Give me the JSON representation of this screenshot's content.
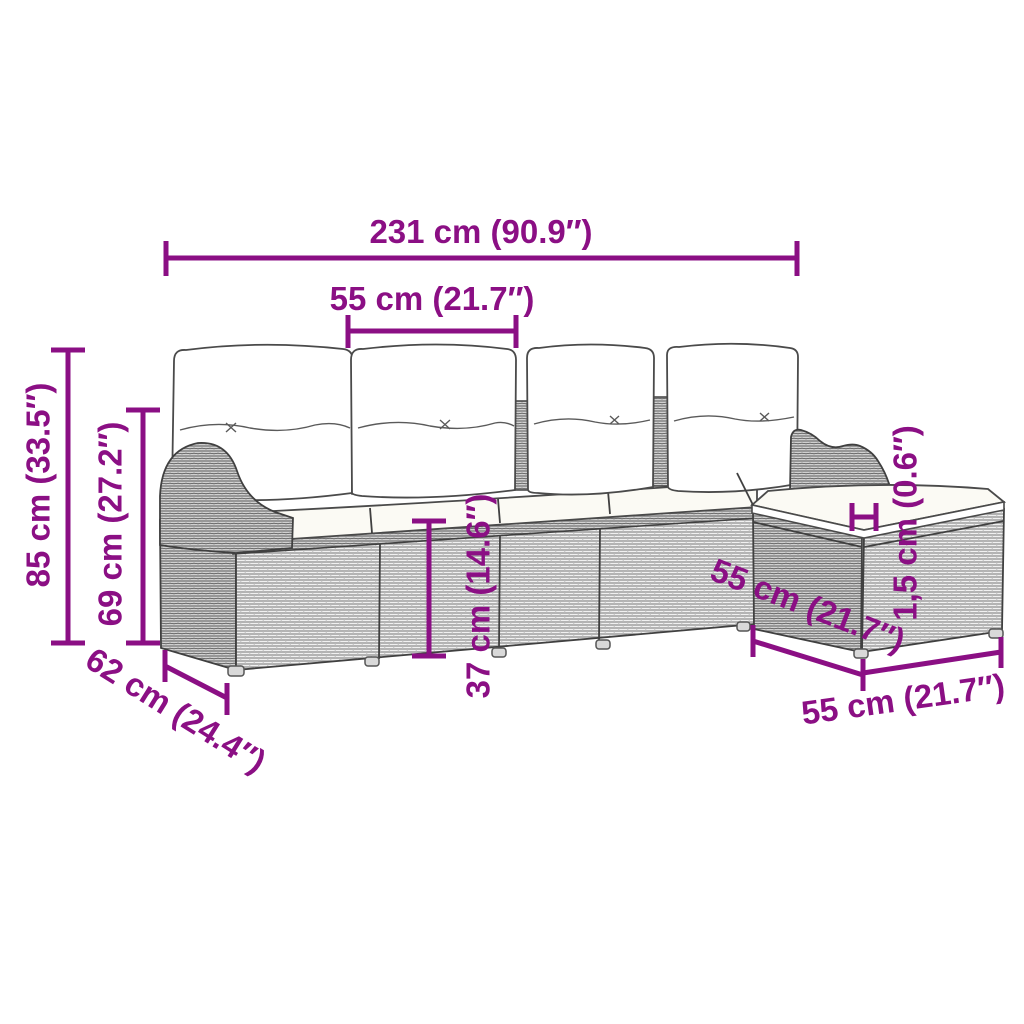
{
  "diagram": {
    "kind": "product-dimension-diagram",
    "subject": "rattan garden sofa set with ottoman and cushions",
    "accent_color": "#8B0F84",
    "labels": {
      "overall_width": "231 cm (90.9″)",
      "module_width": "55 cm (21.7″)",
      "overall_height": "85 cm (33.5″)",
      "backrest_height": "69 cm (27.2″)",
      "seat_height": "37 cm (14.6″)",
      "cushion_thickness": "1,5 cm (0.6″)",
      "ottoman_depth": "55 cm (21.7″)",
      "ottoman_width": "55 cm (21.7″)",
      "seat_depth": "62 cm (24.4″)"
    }
  }
}
